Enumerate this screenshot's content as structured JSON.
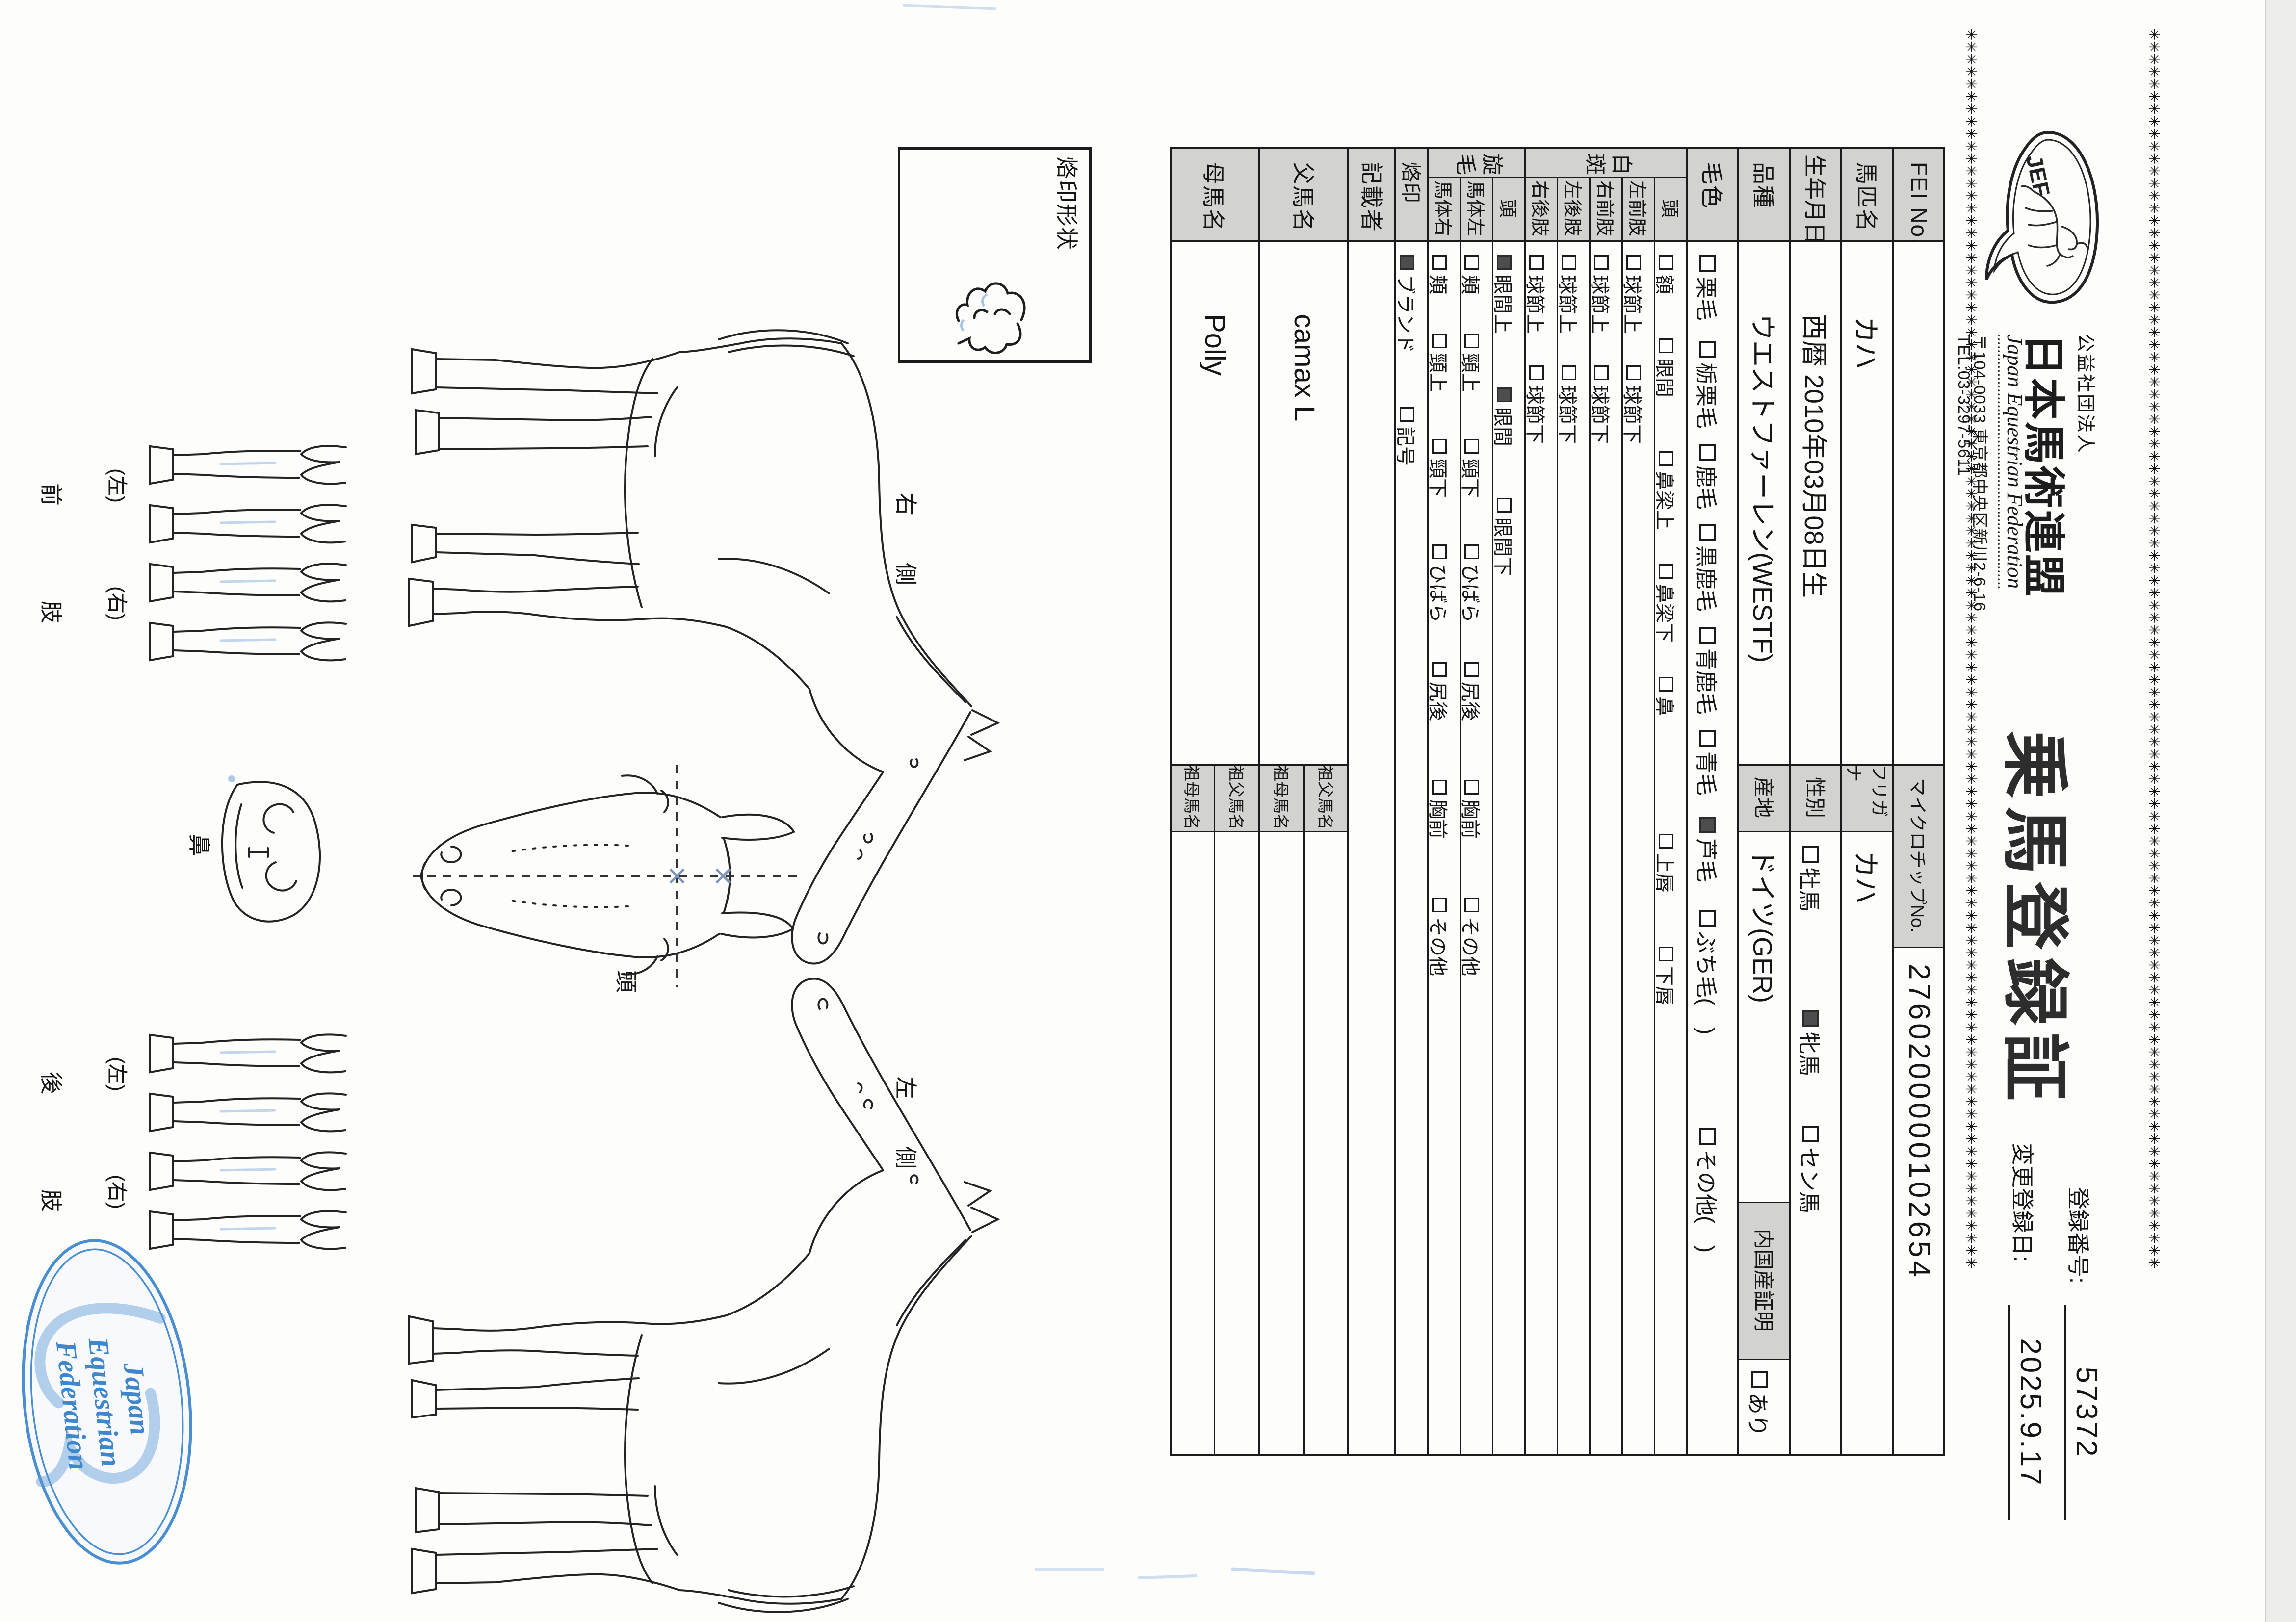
{
  "header": {
    "logo_text": "JEF",
    "org_small": "公益社団法人",
    "org_name": "日本馬術連盟",
    "org_en": "Japan Equestrian Federation",
    "address": "〒104-0033 東京都中央区新川2-6-16",
    "tel": "TEL:03-3297-5611",
    "title": "乗馬登録証",
    "reg_no_label": "登録番号:",
    "reg_no": "57372",
    "change_date_label": "変更登録日:",
    "change_date": "2025.9.17",
    "border_marks": "✳✳✳✳✳✳✳✳✳✳✳✳✳✳✳✳✳✳✳✳✳✳✳✳✳✳✳✳✳✳✳✳✳✳✳✳✳✳✳✳✳✳✳✳✳✳✳✳✳✳✳✳✳✳✳✳✳✳✳✳✳✳✳✳✳✳✳✳✳✳✳✳✳✳✳✳✳✳✳✳✳✳✳✳✳✳✳✳✳✳✳✳✳✳✳✳✳✳✳✳"
  },
  "table": {
    "fei": {
      "label": "FEI No.",
      "chip_label": "マイクロチップNo.",
      "chip_value": "2760200000102654"
    },
    "name": {
      "label": "馬匹名",
      "value": "カハ",
      "kana_label": "フリガナ",
      "kana_value": "カハ"
    },
    "birth": {
      "label": "生年月日",
      "value": "西暦 2010年03月08日生",
      "sex_label": "性別",
      "sex_options": [
        {
          "label": "牡馬",
          "checked": false
        },
        {
          "label": "牝馬",
          "checked": true
        },
        {
          "label": "セン馬",
          "checked": false
        }
      ]
    },
    "breed": {
      "label": "品種",
      "value": "ウエストファーレン(WESTF)",
      "origin_label": "産地",
      "origin_value": "ドイツ(GER)",
      "domestic_label": "内国産証明",
      "domestic_options": [
        {
          "label": "あり",
          "checked": false
        }
      ]
    },
    "coat": {
      "label": "毛色",
      "options": [
        {
          "label": "栗毛",
          "checked": false
        },
        {
          "label": "栃栗毛",
          "checked": false
        },
        {
          "label": "鹿毛",
          "checked": false
        },
        {
          "label": "黒鹿毛",
          "checked": false
        },
        {
          "label": "青鹿毛",
          "checked": false
        },
        {
          "label": "青毛",
          "checked": false
        },
        {
          "label": "芦毛",
          "checked": true
        },
        {
          "label": "ぶち毛(　)",
          "checked": false
        },
        {
          "label": "その他(　)",
          "checked": false
        }
      ]
    },
    "markings": {
      "label": "白斑",
      "rows": [
        {
          "label": "頭",
          "options": [
            {
              "label": "額",
              "checked": false
            },
            {
              "label": "眼間",
              "checked": false
            },
            {
              "label": "鼻梁上",
              "checked": false
            },
            {
              "label": "鼻梁下",
              "checked": false
            },
            {
              "label": "鼻",
              "checked": false
            },
            {
              "label": "上唇",
              "checked": false
            },
            {
              "label": "下唇",
              "checked": false
            }
          ]
        },
        {
          "label": "左前肢",
          "options": [
            {
              "label": "球節上",
              "checked": false
            },
            {
              "label": "球節下",
              "checked": false
            }
          ]
        },
        {
          "label": "右前肢",
          "options": [
            {
              "label": "球節上",
              "checked": false
            },
            {
              "label": "球節下",
              "checked": false
            }
          ]
        },
        {
          "label": "左後肢",
          "options": [
            {
              "label": "球節上",
              "checked": false
            },
            {
              "label": "球節下",
              "checked": false
            }
          ]
        },
        {
          "label": "右後肢",
          "options": [
            {
              "label": "球節上",
              "checked": false
            },
            {
              "label": "球節下",
              "checked": false
            }
          ]
        }
      ]
    },
    "whorls": {
      "label": "旋毛",
      "rows": [
        {
          "label": "頭",
          "options": [
            {
              "label": "眼間上",
              "checked": true
            },
            {
              "label": "眼間",
              "checked": true
            },
            {
              "label": "眼間下",
              "checked": false
            }
          ]
        },
        {
          "label": "馬体左",
          "options": [
            {
              "label": "頬",
              "checked": false
            },
            {
              "label": "頸上",
              "checked": false
            },
            {
              "label": "頸下",
              "checked": false
            },
            {
              "label": "ひばら",
              "checked": false
            },
            {
              "label": "尻後",
              "checked": false
            },
            {
              "label": "胸前",
              "checked": false
            },
            {
              "label": "その他",
              "checked": false
            }
          ]
        },
        {
          "label": "馬体右",
          "options": [
            {
              "label": "頬",
              "checked": false
            },
            {
              "label": "頸上",
              "checked": false
            },
            {
              "label": "頸下",
              "checked": false
            },
            {
              "label": "ひばら",
              "checked": false
            },
            {
              "label": "尻後",
              "checked": false
            },
            {
              "label": "胸前",
              "checked": false
            },
            {
              "label": "その他",
              "checked": false
            }
          ]
        }
      ]
    },
    "brand": {
      "label": "烙印",
      "options": [
        {
          "label": "ブランド",
          "checked": true
        },
        {
          "label": "記号",
          "checked": false
        }
      ]
    },
    "recorder": {
      "label": "記載者",
      "value": ""
    },
    "sire": {
      "label": "父馬名",
      "value": "camax L",
      "grandsire_label": "祖父馬名",
      "grandsire_value": "",
      "granddam_label": "祖母馬名",
      "granddam_value": ""
    },
    "dam": {
      "label": "母馬名",
      "value": "Polly",
      "grandsire_label": "祖父馬名",
      "grandsire_value": "",
      "granddam_label": "祖母馬名",
      "granddam_value": ""
    }
  },
  "diagram": {
    "brand_box_label": "烙印形状",
    "right_side_label": "右側",
    "left_side_label": "左側",
    "head_label": "頭",
    "nose_label": "鼻",
    "front_legs": {
      "left": "(左)",
      "right": "(右)",
      "char1": "前",
      "char2": "肢"
    },
    "hind_legs": {
      "left": "(左)",
      "right": "(右)",
      "char1": "後",
      "char2": "肢"
    }
  },
  "stamp": {
    "line1": "Japan",
    "line2": "Equestrian",
    "line3": "Federation"
  }
}
